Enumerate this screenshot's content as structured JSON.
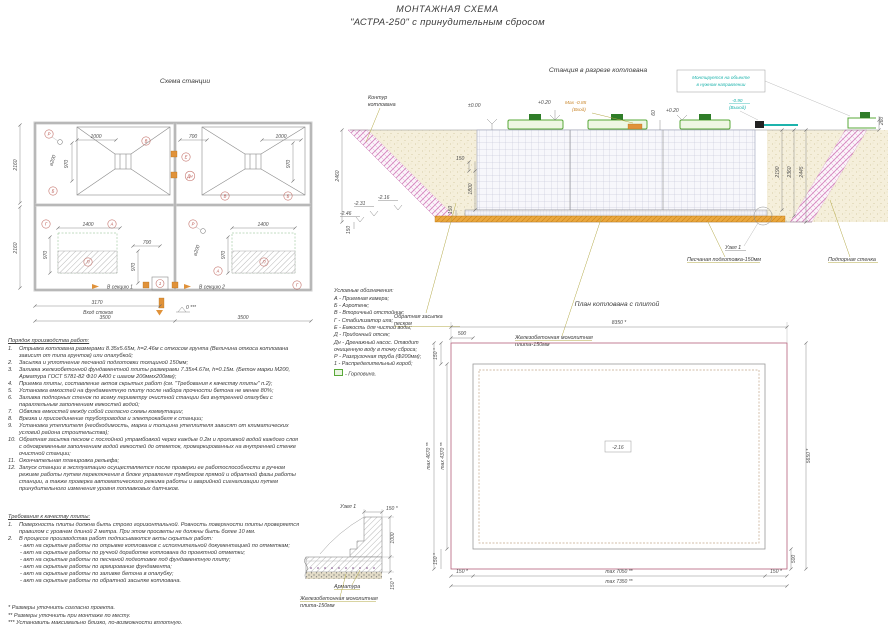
{
  "header": {
    "title": "МОНТАЖНАЯ СХЕМА",
    "subtitle": "\"АСТРА-250\" с принудительным сбросом"
  },
  "scheme": {
    "title": "Схема станции",
    "labels": {
      "P": "Р",
      "V": "В",
      "B": "Б",
      "E": "Е",
      "Dn": "Дн",
      "G": "Г",
      "A": "А",
      "Pp": "П",
      "one": "1",
      "sec1": "В секцию 1",
      "sec2": "В секцию 2",
      "inflow": "Вход стоков"
    },
    "dims": {
      "w1000": "1000",
      "w700": "700",
      "w970": "970",
      "dia200": "⌀200",
      "h2160": "2160",
      "w1400": "1400",
      "w3170": "3170",
      "w3500": "3500",
      "lvl0": "0 ***"
    }
  },
  "section": {
    "title": "Станция в разрезе котлована",
    "labels": {
      "contour": [
        "Контур",
        "котлована"
      ],
      "backfill": [
        "Обратная засыпка",
        "песком"
      ],
      "slab": [
        "Железобетонная монолитная",
        "плита-150мм"
      ],
      "sand": "Песчаная подготовка-150мм",
      "node": "Узел 1",
      "wall": "Подпорная стенка",
      "note": [
        "Монтируется на объекте",
        "в нужном направлении"
      ]
    },
    "levels": {
      "zero": "±0.00",
      "p020": "+0.20",
      "maxin": [
        "Max -0.85",
        "(Вход)"
      ],
      "out": [
        "-0.90",
        "(Выход)"
      ],
      "m216": "-2.16",
      "m231": "-2.31",
      "m246": "-2.46"
    },
    "dims": {
      "d60": "60",
      "d260": "260",
      "d2460": "2460",
      "d150": "150",
      "d1800": "1800",
      "d2190": "2190",
      "d2360": "2360",
      "d2445": "2445"
    }
  },
  "legend": {
    "title": "Условные обозначения:",
    "lines": [
      "А - Приемная камера;",
      "Б - Аэротенк;",
      "В - Вторичный отстойник;",
      "Г - Стабилизатор ила;",
      "Е - Емкость для чистой воды;",
      "Д - Придонный отсек;",
      "Дн - Дренажный насос. Отводит",
      "очищенную воду в точку сброса;",
      "Р - Разгрузочная труба (Ф200мм);",
      "1 - Распределительный короб;"
    ],
    "hatch_item": "- Горловина."
  },
  "plan": {
    "title": "План котлована с плитой",
    "dims": {
      "top": "8350 *",
      "d500": "500",
      "d150": "150 *",
      "left_out": "max 4670 **",
      "left_in": "max 4370 **",
      "right": "5650 *",
      "bot_in": "max 7050 **",
      "bot_out": "max 7350 **",
      "lvl": "-2.16"
    }
  },
  "node": {
    "title": "Узел 1",
    "dims": {
      "d150": "150 *",
      "d1000": "1000"
    },
    "labels": {
      "rebar": "Арматура"
    }
  },
  "work_order": {
    "title": "Порядок производства работ:",
    "items": [
      {
        "n": "1.",
        "text": "Отрывка котлована размерами 8.35х5.65м, h=2.46м с откосом грунта (Величина откоса котлована зависит от типа грунтов) или опалубкой;"
      },
      {
        "n": "2.",
        "text": "Засыпка и уплотнение песчаной подготовки толщиной 150мм;"
      },
      {
        "n": "3.",
        "text": "Заливка железобетонной фундаментной плиты размерами 7.35х4.67м, h=0.15м. (Бетон марки М200, Арматура ГОСТ 5781-82 Ф10 А400 с шагом 200ммх200мм);"
      },
      {
        "n": "4.",
        "text": "Приемка плиты, составление актов скрытых работ (см. \"Требования к качеству плиты\" п.2);"
      },
      {
        "n": "5.",
        "text": "Установка емкостей на фундаментную плиту после набора прочности бетона не менее 80%;"
      },
      {
        "n": "6.",
        "text": "Заливка подпорных стенок по всему периметру очистной станции без внутренней опалубки с параллельным заполнением емкостей водой;"
      },
      {
        "n": "7.",
        "text": "Обвязка емкостей между собой согласно схемы коммутации;"
      },
      {
        "n": "8.",
        "text": "Врезка и присоединение трубопроводов и электрокабеля к станции;"
      },
      {
        "n": "9.",
        "text": "Установка утеплителя (необходимость, марка и толщина утеплителя зависят от климатических условий района строительства);"
      },
      {
        "n": "10.",
        "text": "Обратная засыпка песком с послойной утрамбовкой через каждые 0.2м и проливкой водой каждого слоя с одновременным заполнением водой емкостей до отметок, промаркированных на внутренней стенке очистной станции;"
      },
      {
        "n": "11.",
        "text": "Окончательная планировка рельефа;"
      },
      {
        "n": "12.",
        "text": "Запуск станции в эксплуатацию осуществляется после проверки ее работоспособности в ручном режиме работы путем переключения в блоке управления тумблеров прямой и обратной фазы работы станции, а также проверка автоматического режима работы и аварийной сигнализации путем принудительного изменения уровня поплавковых датчиков."
      }
    ]
  },
  "requirements": {
    "title": "Требования к качеству плиты:",
    "items": [
      {
        "n": "1.",
        "text": "Поверхность плиты должна быть строго горизонтальной. Ровность поверхности плиты проверяется правилом с уровнем длиной 2 метра. При этом просветы не должны быть более 10 мм."
      },
      {
        "n": "2.",
        "text": "В процессе производства работ подписываются акты скрытых работ:"
      }
    ],
    "acts": [
      "- акт на скрытые работы по отрывке котлованов с исполнительной документацией по отметкам;",
      "- акт на скрытые работы по ручной доработке котлована до проектной отметки;",
      "- акт на скрытые работы по песчаной подготовке под фундаментную плиту;",
      "- акт на скрытые работы по армирование фундамента;",
      "- акт на скрытые работы по заливке бетона в опалубку;",
      "- акт на скрытые работы по обратной засыпке котлована."
    ]
  },
  "footnotes": [
    "* Размеры уточнить согласно проекта.",
    "** Размеры уточнить при монтаже по месту.",
    "*** Установить максимально близко, по-возможности вплотную."
  ]
}
